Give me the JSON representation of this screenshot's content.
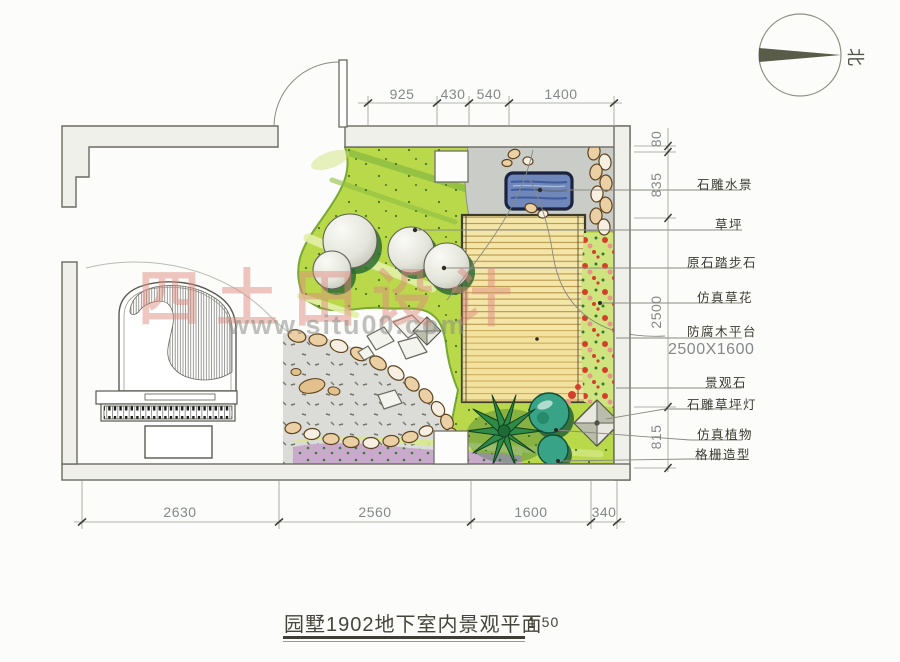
{
  "title": {
    "text": "园墅1902地下室内景观平面",
    "scale": "1:50"
  },
  "north_label": "北",
  "watermark": {
    "brand": "四土田设计",
    "url": "www.situ00.com"
  },
  "dimensions": {
    "top": [
      "925",
      "430",
      "540",
      "1400"
    ],
    "bottom": [
      "2630",
      "2560",
      "1600",
      "340"
    ],
    "right": [
      "80",
      "835",
      "2500",
      "815"
    ]
  },
  "labels": {
    "water": "石雕水景",
    "lawn": "草坪",
    "stepping": "原石踏步石",
    "flowers": "仿真草花",
    "deck": "防腐木平台",
    "deck_size": "2500X1600",
    "rock": "景观石",
    "lamp": "石雕草坪灯",
    "plants": "仿真植物",
    "lattice": "格栅造型"
  },
  "colors": {
    "lawn": "#b9d94b",
    "deck": "#f4e5a9",
    "water": "#6f87ba",
    "paving": "#caccc7",
    "gravel": "#dbdcd7",
    "pebble": "#ead0a4",
    "flower_red": "#d2402c",
    "purple": "#c9a9cc",
    "bush": "#38a386",
    "wall": "#f0f0ea",
    "watermark_pink": "#dd8a7e"
  }
}
